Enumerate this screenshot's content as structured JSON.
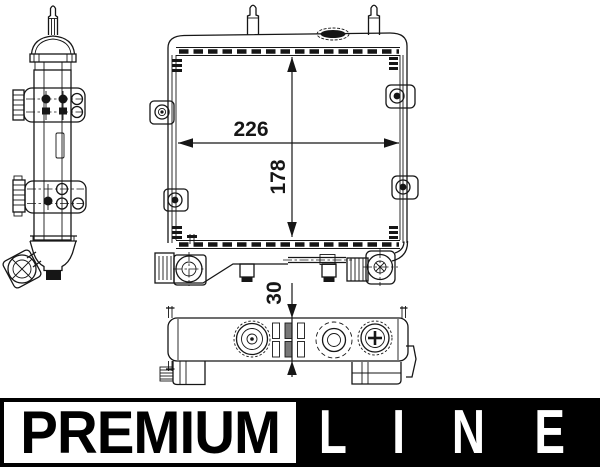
{
  "drawing": {
    "type": "technical-drawing-oil-cooler",
    "line_color": "#161616",
    "background": "#ffffff",
    "dimensions": {
      "core_width": "226",
      "core_height": "178",
      "depth": "30"
    }
  },
  "banner": {
    "premium_label": "PREMIUM",
    "line_letters": [
      "L",
      "I",
      "N",
      "E"
    ],
    "colors": {
      "premium_bg": "#ffffff",
      "premium_text": "#000000",
      "border": "#000000",
      "line_bg": "#000000",
      "line_text": "#ffffff"
    }
  }
}
